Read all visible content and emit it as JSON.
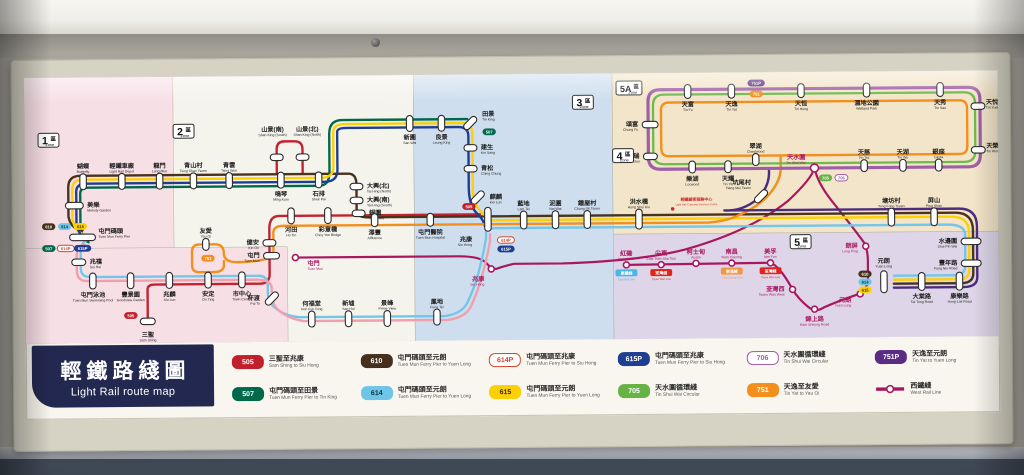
{
  "title": {
    "zh": "輕鐵路綫圖",
    "en": "Light Rail route map"
  },
  "zone_word": {
    "zh": "區",
    "en": "Zone"
  },
  "colors": {
    "wr": "#a81760",
    "map_bg": "#faf8f1",
    "routes": {
      "505": {
        "bg": "#bf202c",
        "fg": "#ffffff"
      },
      "507": {
        "bg": "#00694b",
        "fg": "#ffffff"
      },
      "610": {
        "bg": "#46301d",
        "fg": "#ffffff"
      },
      "614": {
        "bg": "#6ec5e8",
        "fg": "#12303c"
      },
      "614P": {
        "bg": "#ffffff",
        "fg": "#d6452e",
        "border": "#d6452e"
      },
      "615": {
        "bg": "#fdd005",
        "fg": "#3a3000"
      },
      "615P": {
        "bg": "#1e3e92",
        "fg": "#ffffff"
      },
      "705": {
        "bg": "#66b245",
        "fg": "#ffffff"
      },
      "706": {
        "bg": "#ffffff",
        "fg": "#a05da6",
        "border": "#a05da6"
      },
      "751": {
        "bg": "#f28f1d",
        "fg": "#ffffff"
      },
      "751P": {
        "bg": "#5a2c84",
        "fg": "#ffffff"
      }
    },
    "line_colors": {
      "505": "#c32330",
      "507": "#00694b",
      "610": "#4a321e",
      "614": "#74c6e8",
      "614P": "#f0a0ac",
      "615": "#fdd005",
      "615P": "#1e3e92",
      "705": "#6fb94d",
      "706": "#9e5fa7",
      "751": "#f28f1d",
      "751P": "#4c2c7d",
      "wr": "#a81760"
    }
  },
  "panels": [
    {
      "x": 130,
      "y": 0,
      "w": 262,
      "h": 268,
      "c": "#f4f3ec"
    },
    {
      "x": 0,
      "y": 0,
      "w": 150,
      "h": 268,
      "c": "#f7dfe6"
    },
    {
      "x": 0,
      "y": 172,
      "w": 264,
      "h": 96,
      "c": "#f7dfe6"
    },
    {
      "x": 392,
      "y": 0,
      "w": 200,
      "h": 268,
      "c": "#cfdeee"
    },
    {
      "x": 592,
      "y": 0,
      "w": 388,
      "h": 162,
      "c": "#f3e5ca"
    },
    {
      "x": 592,
      "y": 162,
      "w": 388,
      "h": 106,
      "c": "#ded6e8"
    }
  ],
  "zones": [
    {
      "num": "1",
      "x": 14,
      "y": 56
    },
    {
      "num": "2",
      "x": 150,
      "y": 48
    },
    {
      "num": "3",
      "x": 552,
      "y": 22
    },
    {
      "num": "4",
      "x": 592,
      "y": 76
    },
    {
      "num": "5A",
      "x": 596,
      "y": 8
    },
    {
      "num": "5",
      "x": 770,
      "y": 164
    }
  ],
  "routes": [
    {
      "id": "wr",
      "w": 2.2,
      "d": "M272,183 L436,183 Q458,183 464,190 Q469,196 474,196 Q482,193 492,191 L540,191 Q620,189 664,178 Q730,160 768,130 Q792,108 795,97 Q798,112 812,130 Q834,158 844,172 Q848,180 848,190 L848,208 Q848,221 836,225 Q818,231 804,237 Q795,243 788,237 Q778,229 772,219 Q764,204 757,197 Q753,192 746,192 L605,193"
    },
    {
      "id": "505",
      "w": 2.4,
      "d": "M123,246 L123,214 Q123,209 130,209 L236,209 Q246,209 246,199 L246,154 Q246,141 256,141 L326,141 L458,141 M254,99 L254,74 Q254,66 262,66 L272,66 Q280,66 280,74 L280,99"
    },
    {
      "id": "507",
      "w": 2.4,
      "d": "M64,166 Q58,164 56,150 L56,117 Q56,111 64,111 L296,111 Q307,111 307,97 L307,59 Q307,45 320,45 L446,45"
    },
    {
      "id": "610",
      "w": 2.4,
      "d": "M58,154 Q46,152 44,140 L44,111 Q44,99 56,99 L326,99 Q334,99 334,110 L334,135 Q334,143 344,143 L936,143 Q954,143 954,161 L954,204 Q954,214 942,214 L874,214"
    },
    {
      "id": "615",
      "w": 2.4,
      "d": "M60,158 Q50,156 48,142 L48,113 Q48,103 58,103 L298,103 Q311,103 311,92 L311,58 Q311,49 322,49 L441,49 Q451,49 451,60 L451,114 Q451,130 459,138 Q466,145 468,147 L932,147 Q950,147 950,163 L950,200 Q950,210 940,210 L874,210"
    },
    {
      "id": "615P",
      "w": 2.4,
      "d": "M62,162 Q54,160 52,146 L52,115 Q52,107 62,107 L302,107 Q315,107 315,95 L315,57 Q315,53 324,53 L437,53 Q447,53 447,62 L447,114 Q447,132 455,140 Q461,146 462,150 L463,153"
    },
    {
      "id": "614",
      "w": 2.4,
      "d": "M62,164 Q56,166 56,178 L56,192 Q56,201 66,201 L234,201 Q244,201 244,210 L244,218 Q244,228 252,234 Q262,242 276,243 L422,243 Q438,241 444,231 Q452,215 456,200 Q461,182 464,165 L464,158 Q466,155 474,155 L928,155 Q946,155 946,165 L946,196 Q946,206 936,206 L874,206"
    },
    {
      "id": "614P",
      "w": 2.4,
      "d": "M60,168 Q52,170 52,180 L52,194 Q52,205 62,205 L232,205 Q248,205 248,214 L248,220 Q248,231 256,237 Q266,245 280,247 L424,247 Q442,245 448,234 Q456,217 460,202 Q465,184 468,168 L468,161"
    },
    {
      "id": "751",
      "w": 2.4,
      "d": "M250,182 L250,158 Q250,151 260,151 L688,151 Q704,150 716,145 Q740,135 751,121 Q760,110 761,99 L761,85 M250,182 Q232,188 210,187 Q200,186 200,178 Q200,169 191,169 L176,169 Q168,169 168,176 L168,190 Q168,197 176,197 L190,197 Q200,197 200,190 L200,186 M649,30 L941,30 Q949,30 949,38 L949,76 Q949,84 941,84 L649,84 Q641,84 641,76 L641,38 Q641,30 649,30 Z"
    },
    {
      "id": "751P",
      "w": 2.4,
      "d": "M749,97 Q751,114 737,128 Q722,140 704,139 L940,139 Q958,139 958,157 L958,208 Q958,218 944,218 L874,218"
    },
    {
      "id": "706",
      "w": 3.2,
      "d": "M640,17 L950,17 Q962,17 962,29 L962,85 Q962,97 950,97 L640,97 Q628,97 628,85 L628,29 Q628,17 640,17 Z"
    },
    {
      "id": "705",
      "w": 2.3,
      "d": "M644,22 L946,22 Q957,22 957,33 L957,81 Q957,92 946,92 L644,92 Q633,92 633,81 L633,33 Q633,22 644,22 Z"
    }
  ],
  "stations": [
    {
      "zh": "蝴蝶",
      "en": "Butterfly",
      "x": 59,
      "y": 105,
      "o": "v",
      "lp": "above"
    },
    {
      "zh": "輕鐵車廠",
      "en": "Light Rail Depot",
      "x": 98,
      "y": 105,
      "o": "v",
      "lp": "above"
    },
    {
      "zh": "龍門",
      "en": "Lung Mun",
      "x": 136,
      "y": 105,
      "o": "v",
      "lp": "above"
    },
    {
      "zh": "青山村",
      "en": "Tsing Shan Tsuen",
      "x": 170,
      "y": 105,
      "o": "v",
      "lp": "above"
    },
    {
      "zh": "青雲",
      "en": "Tsing Wun",
      "x": 206,
      "y": 105,
      "o": "v",
      "lp": "above"
    },
    {
      "zh": "鳴琴",
      "en": "Ming Kum",
      "x": 258,
      "y": 105,
      "o": "v",
      "lp": "below"
    },
    {
      "zh": "石排",
      "en": "Shek Pai",
      "x": 296,
      "y": 105,
      "o": "v",
      "lp": "below"
    },
    {
      "zh": "山景(南)",
      "en": "Shan King (South)",
      "x": 254,
      "y": 82,
      "o": "h",
      "w": 13,
      "lx": 250,
      "ly": 56,
      "la": "middle"
    },
    {
      "zh": "山景(北)",
      "en": "Shan King (North)",
      "x": 280,
      "y": 82,
      "o": "h",
      "w": 13,
      "lx": 285,
      "ly": 56,
      "la": "middle"
    },
    {
      "zh": "美樂",
      "en": "Melody Garden",
      "x": 50,
      "y": 129,
      "o": "h",
      "w": 18,
      "lp": "right"
    },
    {
      "zh": "屯門碼頭",
      "en": "Tuen Mun Ferry Pier",
      "x": 58,
      "y": 161,
      "o": "h",
      "w": 26,
      "lx": 74,
      "ly": 157,
      "la": "start"
    },
    {
      "zh": "兆禧",
      "en": "Siu Hei",
      "x": 54,
      "y": 186,
      "o": "h",
      "w": 14,
      "lp": "right"
    },
    {
      "zh": "屯門泳池",
      "en": "Tuen Mun Swimming Pool",
      "x": 68,
      "y": 205,
      "o": "v",
      "lp": "below"
    },
    {
      "zh": "豐景園",
      "en": "Goodview Garden",
      "x": 106,
      "y": 205,
      "o": "v",
      "lp": "below"
    },
    {
      "zh": "兆麟",
      "en": "Siu Lun",
      "x": 145,
      "y": 205,
      "o": "v",
      "lp": "below"
    },
    {
      "zh": "三聖",
      "en": "Sam Shing",
      "x": 123,
      "y": 246,
      "o": "h",
      "w": 15,
      "lp": "below"
    },
    {
      "zh": "安定",
      "en": "On Ting",
      "x": 184,
      "y": 205,
      "o": "v",
      "lp": "below"
    },
    {
      "zh": "市中心",
      "en": "Town Centre",
      "x": 218,
      "y": 205,
      "o": "v",
      "lp": "below"
    },
    {
      "zh": "友愛",
      "en": "Yau Oi",
      "x": 182,
      "y": 169,
      "o": "v",
      "w": 12,
      "lp": "above"
    },
    {
      "zh": "屯門",
      "en": "Tuen Mun",
      "x": 248,
      "y": 181,
      "o": "h",
      "w": 16,
      "lp": "left"
    },
    {
      "zh": "屯門",
      "en": "Tuen Mun",
      "x": 272,
      "y": 183,
      "t": "c",
      "c": "wr",
      "lx": 284,
      "ly": 191,
      "la": "start"
    },
    {
      "zh": "杯渡",
      "en": "Pui To",
      "x": 248,
      "y": 224,
      "o": "d",
      "lp": "left"
    },
    {
      "zh": "何福堂",
      "en": "Hoh Fuk Tong",
      "x": 288,
      "y": 245,
      "o": "v",
      "lp": "above"
    },
    {
      "zh": "新墟",
      "en": "San Hui",
      "x": 325,
      "y": 245,
      "o": "v",
      "lp": "above"
    },
    {
      "zh": "景峰",
      "en": "Prime View",
      "x": 364,
      "y": 245,
      "o": "v",
      "lp": "above"
    },
    {
      "zh": "鳳地",
      "en": "Fung Tei",
      "x": 414,
      "y": 244,
      "o": "v",
      "lp": "above"
    },
    {
      "zh": "健安",
      "en": "Kin On",
      "x": 246,
      "y": 168,
      "o": "h",
      "w": 13,
      "lp": "left"
    },
    {
      "zh": "河田",
      "en": "Ho Tin",
      "x": 268,
      "y": 141,
      "o": "v",
      "lp": "below"
    },
    {
      "zh": "彩意橋",
      "en": "Choy Yee Bridge",
      "x": 305,
      "y": 141,
      "o": "v",
      "lp": "below"
    },
    {
      "zh": "大興(北)",
      "en": "Tai Hing (North)",
      "x": 334,
      "y": 112,
      "o": "h",
      "w": 13,
      "lp": "right"
    },
    {
      "zh": "大興(南)",
      "en": "Tai Hing (South)",
      "x": 334,
      "y": 126,
      "o": "h",
      "w": 13,
      "lp": "right"
    },
    {
      "zh": "銀圍",
      "en": "Ngan Wai",
      "x": 336,
      "y": 139,
      "o": "h",
      "w": 13,
      "lp": "right"
    },
    {
      "zh": "新圍",
      "en": "San Wai",
      "x": 388,
      "y": 49,
      "o": "v",
      "lp": "below"
    },
    {
      "zh": "良景",
      "en": "Leung King",
      "x": 420,
      "y": 49,
      "o": "v",
      "lp": "below"
    },
    {
      "zh": "田景",
      "en": "Tin King",
      "x": 449,
      "y": 49,
      "o": "d",
      "lx": 461,
      "ly": 42,
      "la": "start"
    },
    {
      "zh": "建生",
      "en": "Kin Sang",
      "x": 449,
      "y": 74,
      "o": "h",
      "w": 13,
      "lp": "right"
    },
    {
      "zh": "青松",
      "en": "Ching Chung",
      "x": 449,
      "y": 95,
      "o": "h",
      "w": 13,
      "lp": "right"
    },
    {
      "zh": "麒麟",
      "en": "Kei Lun",
      "x": 456,
      "y": 124,
      "o": "d",
      "lp": "right"
    },
    {
      "zh": "澤豐",
      "en": "Affluence",
      "x": 352,
      "y": 146,
      "o": "v",
      "w": 13,
      "lp": "below"
    },
    {
      "zh": "屯門醫院",
      "en": "Tuen Mun Hospital",
      "x": 408,
      "y": 146,
      "o": "v",
      "w": 13,
      "lp": "below"
    },
    {
      "zh": "兆康",
      "en": "Siu Hong",
      "x": 466,
      "y": 146,
      "o": "v",
      "w": 24,
      "lx": 450,
      "ly": 168,
      "la": "end"
    },
    {
      "zh": "兆康",
      "en": "Siu Hong",
      "x": 469,
      "y": 196,
      "t": "c",
      "c": "wr",
      "lx": 462,
      "ly": 208,
      "la": "end"
    },
    {
      "zh": "藍地",
      "en": "Lam Tei",
      "x": 502,
      "y": 147,
      "o": "v",
      "w": 18,
      "lp": "above"
    },
    {
      "zh": "泥圍",
      "en": "Nai Wai",
      "x": 534,
      "y": 147,
      "o": "v",
      "w": 18,
      "lp": "above"
    },
    {
      "zh": "鍾屋村",
      "en": "Chung Uk Tsuen",
      "x": 566,
      "y": 147,
      "o": "v",
      "w": 18,
      "lp": "above"
    },
    {
      "zh": "洪水橋",
      "en": "Hung Shui Kiu",
      "x": 618,
      "y": 147,
      "o": "v",
      "w": 20,
      "lp": "above"
    },
    {
      "zh": "坑尾村",
      "en": "Hang Mei Tsuen",
      "x": 741,
      "y": 125,
      "o": "d",
      "lx": 731,
      "ly": 113,
      "la": "end"
    },
    {
      "zh": "塘坊村",
      "en": "Tong Fong Tsuen",
      "x": 872,
      "y": 147,
      "o": "v",
      "w": 18,
      "lp": "above"
    },
    {
      "zh": "屏山",
      "en": "Ping Shan",
      "x": 915,
      "y": 147,
      "o": "v",
      "w": 18,
      "lp": "above"
    },
    {
      "zh": "水邊圍",
      "en": "Shui Pin Wai",
      "x": 952,
      "y": 172,
      "o": "h",
      "w": 20,
      "lp": "left"
    },
    {
      "zh": "豐年路",
      "en": "Fung Nin Road",
      "x": 952,
      "y": 194,
      "o": "h",
      "w": 20,
      "lp": "left"
    },
    {
      "zh": "元朗",
      "en": "Yuen Long",
      "x": 864,
      "y": 212,
      "o": "v",
      "w": 22,
      "lx": 864,
      "ly": 193,
      "la": "middle"
    },
    {
      "zh": "大棠路",
      "en": "Tai Tong Road",
      "x": 902,
      "y": 212,
      "o": "v",
      "w": 18,
      "lp": "below"
    },
    {
      "zh": "康樂路",
      "en": "Hong Lok Road",
      "x": 940,
      "y": 212,
      "o": "v",
      "w": 18,
      "lp": "below"
    },
    {
      "zh": "紅磡",
      "en": "Hung Hom",
      "x": 605,
      "y": 193,
      "t": "c",
      "c": "wr",
      "lp": "above"
    },
    {
      "zh": "尖東",
      "en": "East Tsim Sha Tsui",
      "x": 640,
      "y": 193,
      "t": "c",
      "c": "wr",
      "lp": "above"
    },
    {
      "zh": "柯士甸",
      "en": "Austin",
      "x": 675,
      "y": 192,
      "t": "c",
      "c": "wr",
      "lp": "above"
    },
    {
      "zh": "南昌",
      "en": "Nam Cheong",
      "x": 711,
      "y": 192,
      "t": "c",
      "c": "wr",
      "lp": "above"
    },
    {
      "zh": "美孚",
      "en": "Mei Foo",
      "x": 750,
      "y": 192,
      "t": "c",
      "c": "wr",
      "lp": "above"
    },
    {
      "zh": "荃灣西",
      "en": "Tsuen Wan West",
      "x": 772,
      "y": 219,
      "t": "c",
      "c": "wr",
      "lp": "left"
    },
    {
      "zh": "錦上路",
      "en": "Kam Sheung Road",
      "x": 794,
      "y": 239,
      "t": "c",
      "c": "wr",
      "lp": "below"
    },
    {
      "zh": "元朗",
      "en": "Yuen Long",
      "x": 840,
      "y": 224,
      "t": "c",
      "c": "wr",
      "lx": 831,
      "ly": 232,
      "la": "end"
    },
    {
      "zh": "朗屏",
      "en": "Long Ping",
      "x": 846,
      "y": 176,
      "t": "c",
      "c": "wr",
      "lp": "left"
    },
    {
      "zh": "天水圍",
      "en": "Tin Shui Wai",
      "x": 795,
      "y": 97,
      "t": "c",
      "c": "wr",
      "r": 4,
      "lx": 786,
      "ly": 88,
      "la": "end"
    },
    {
      "zh": "頌富",
      "en": "Chung Fu",
      "x": 630,
      "y": 52,
      "o": "h",
      "w": 16,
      "lp": "left"
    },
    {
      "zh": "天富",
      "en": "Tin Fu",
      "x": 668,
      "y": 19,
      "o": "v",
      "w": 14,
      "lp": "below"
    },
    {
      "zh": "天逸",
      "en": "Tin Yat",
      "x": 712,
      "y": 19,
      "o": "v",
      "w": 14,
      "lp": "below"
    },
    {
      "zh": "天恒",
      "en": "Tin Heng",
      "x": 782,
      "y": 19,
      "o": "v",
      "w": 14,
      "lp": "below"
    },
    {
      "zh": "濕地公園",
      "en": "Wetland Park",
      "x": 848,
      "y": 19,
      "o": "v",
      "w": 14,
      "lp": "below"
    },
    {
      "zh": "天秀",
      "en": "Tin Sau",
      "x": 922,
      "y": 19,
      "o": "v",
      "w": 14,
      "lp": "below"
    },
    {
      "zh": "天悅",
      "en": "Tin Yuet",
      "x": 960,
      "y": 36,
      "o": "h",
      "w": 14,
      "lx": 968,
      "ly": 34,
      "la": "start"
    },
    {
      "zh": "天榮",
      "en": "Tin Wing",
      "x": 960,
      "y": 80,
      "o": "h",
      "w": 14,
      "lx": 968,
      "ly": 78,
      "la": "start"
    },
    {
      "zh": "翠湖",
      "en": "Chestwood",
      "x": 736,
      "y": 88,
      "o": "v",
      "w": 12,
      "lp": "above"
    },
    {
      "zh": "天瑞",
      "en": "Tin Shui",
      "x": 630,
      "y": 84,
      "o": "h",
      "w": 14,
      "lp": "left"
    },
    {
      "zh": "樂湖",
      "en": "Locwood",
      "x": 672,
      "y": 95,
      "o": "v",
      "w": 12,
      "lp": "below"
    },
    {
      "zh": "天耀",
      "en": "Tin Yiu",
      "x": 708,
      "y": 95,
      "o": "v",
      "w": 12,
      "lp": "below"
    },
    {
      "zh": "天慈",
      "en": "Tin Tsz",
      "x": 845,
      "y": 95,
      "o": "v",
      "w": 12,
      "lp": "above"
    },
    {
      "zh": "天湖",
      "en": "Tin Wu",
      "x": 884,
      "y": 95,
      "o": "v",
      "w": 12,
      "lp": "above"
    },
    {
      "zh": "銀座",
      "en": "Ginza",
      "x": 920,
      "y": 95,
      "o": "v",
      "w": 12,
      "lp": "above"
    }
  ],
  "badges": [
    {
      "r": "610",
      "x": 24,
      "y": 150
    },
    {
      "r": "614",
      "x": 40,
      "y": 150
    },
    {
      "r": "615",
      "x": 56,
      "y": 150
    },
    {
      "r": "507",
      "x": 24,
      "y": 172
    },
    {
      "r": "614P",
      "x": 41,
      "y": 172
    },
    {
      "r": "615P",
      "x": 58,
      "y": 172
    },
    {
      "r": "505",
      "x": 106,
      "y": 240
    },
    {
      "r": "751",
      "x": 184,
      "y": 183
    },
    {
      "r": "507",
      "x": 468,
      "y": 58
    },
    {
      "r": "505",
      "x": 447,
      "y": 133
    },
    {
      "r": "614P",
      "x": 484,
      "y": 167
    },
    {
      "r": "615P",
      "x": 484,
      "y": 176
    },
    {
      "r": "705",
      "x": 806,
      "y": 107
    },
    {
      "r": "706",
      "x": 822,
      "y": 107
    },
    {
      "r": "751P",
      "x": 737,
      "y": 11
    },
    {
      "r": "751",
      "x": 737,
      "y": 22
    },
    {
      "r": "610",
      "x": 845,
      "y": 204
    },
    {
      "r": "614",
      "x": 845,
      "y": 212
    },
    {
      "r": "615",
      "x": 845,
      "y": 220
    }
  ],
  "wr_tags": [
    {
      "x": 605,
      "y": 193,
      "zh": "東鐵綫",
      "en": "East Rail Line",
      "color": "#4ab5e6"
    },
    {
      "x": 640,
      "y": 193,
      "zh": "荃灣綫",
      "en": "Tsuen Wan Line",
      "color": "#e2231a"
    },
    {
      "x": 711,
      "y": 192,
      "zh": "東涌綫",
      "en": "Tung Chung Line",
      "color": "#f7943e"
    },
    {
      "x": 750,
      "y": 192,
      "zh": "荃灣綫",
      "en": "Tsuen Wan Line",
      "color": "#e2231a"
    }
  ],
  "annotation": {
    "zh": "輕鐵顧客服務中心",
    "en": "Light Rail Customer Services Centre",
    "x": 676,
    "y": 129,
    "dot_x": 652,
    "dot_y": 137
  },
  "legend": {
    "items": [
      {
        "route": "505",
        "zh": "三聖至兆康",
        "en": "Sam Shing to Siu Hong"
      },
      {
        "route": "507",
        "zh": "屯門碼頭至田景",
        "en": "Tuen Mun Ferry Pier to Tin King"
      },
      {
        "route": "610",
        "zh": "屯門碼頭至元朗",
        "en": "Tuen Mun Ferry Pier to Yuen Long"
      },
      {
        "route": "614",
        "zh": "屯門碼頭至元朗",
        "en": "Tuen Mun Ferry Pier to Yuen Long"
      },
      {
        "route": "614P",
        "zh": "屯門碼頭至兆康",
        "en": "Tuen Mun Ferry Pier to Siu Hong"
      },
      {
        "route": "615",
        "zh": "屯門碼頭至元朗",
        "en": "Tuen Mun Ferry Pier to Yuen Long"
      },
      {
        "route": "615P",
        "zh": "屯門碼頭至兆康",
        "en": "Tuen Mun Ferry Pier to Siu Hong"
      },
      {
        "route": "705",
        "zh": "天水圍循環綫",
        "en": "Tin Shui Wai Circular"
      },
      {
        "route": "706",
        "zh": "天水圍循環綫",
        "en": "Tin Shui Wai Circular"
      },
      {
        "route": "751",
        "zh": "天逸至友愛",
        "en": "Tin Yat to Yau Oi"
      },
      {
        "route": "751P",
        "zh": "天逸至元朗",
        "en": "Tin Yat to Yuen Long"
      },
      {
        "route": "WRL",
        "symbol": "line",
        "zh": "西鐵綫",
        "en": "West Rail Line"
      }
    ]
  }
}
